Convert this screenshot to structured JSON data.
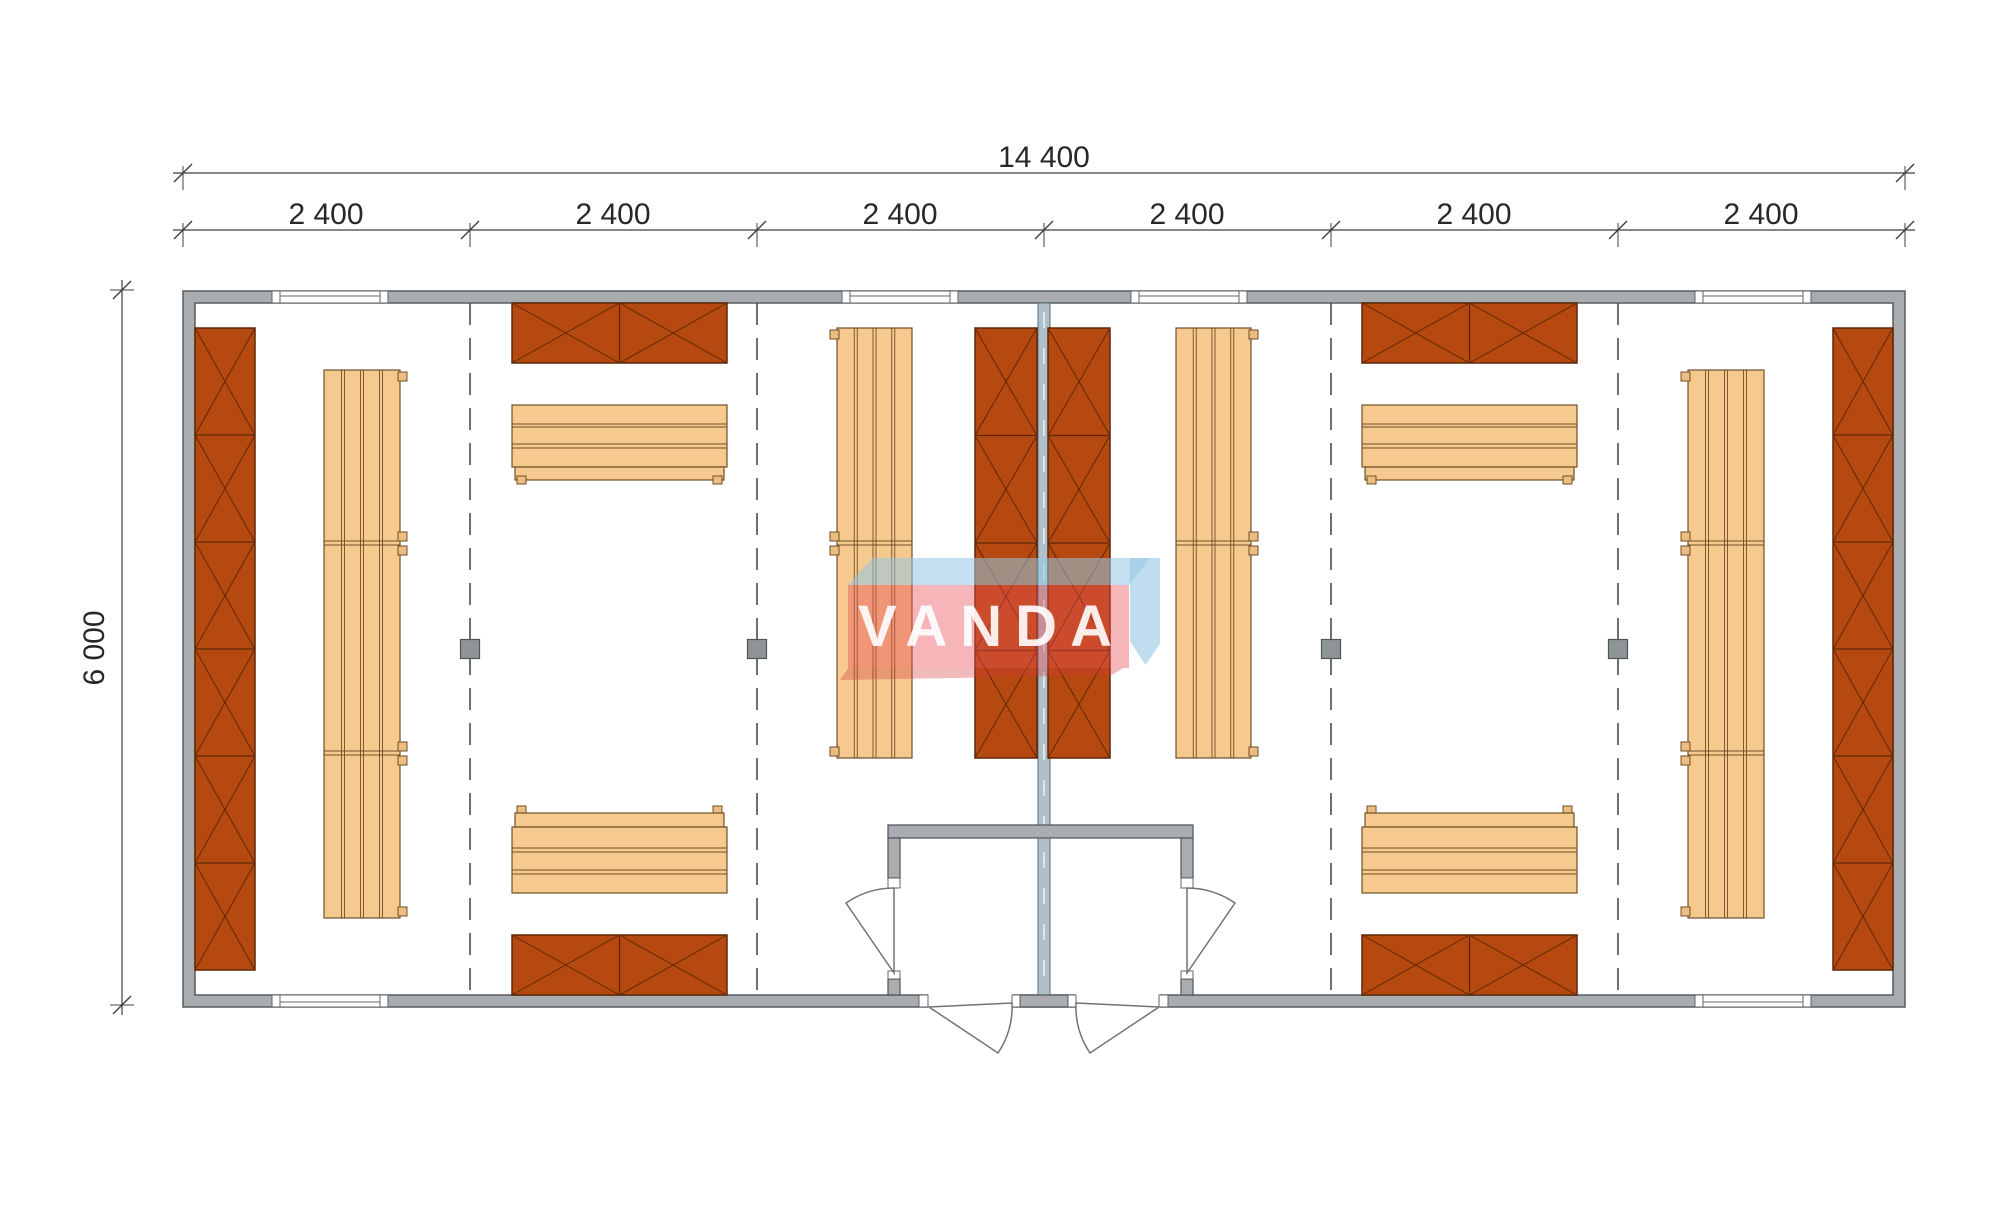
{
  "page": {
    "background": "#ffffff",
    "type": "architectural floor plan"
  },
  "dimensions": {
    "overall_width": "14 400",
    "segments": [
      "2 400",
      "2 400",
      "2 400",
      "2 400",
      "2 400",
      "2 400"
    ],
    "height": "6 000"
  },
  "watermark": {
    "text": "VANDA"
  },
  "colors": {
    "wall_fill": "#a9adb0",
    "wall_stroke": "#595d60",
    "partition_fill": "#afc0ca",
    "partition_stroke": "#5d6e79",
    "partition_dash": "#e8eef2",
    "cabinet_fill": "#b5490f",
    "cabinet_stroke": "#5f2706",
    "bench_fill": "#f6c98f",
    "bench_stroke": "#6f4f26",
    "tab_fill": "#edbc80",
    "grid_line": "#4a4e52",
    "dim_color": "#3c4043",
    "door_stroke": "#6f7377",
    "window_stroke": "#60646a",
    "post_fill": "#8f9497",
    "post_stroke": "#505458"
  },
  "plan": {
    "outer_wall": {
      "x": 183,
      "y": 291,
      "w": 1722,
      "h": 716,
      "thickness": 12
    },
    "cabinets": [
      {
        "x": 195,
        "y": 328,
        "w": 60,
        "h": 642,
        "cells": 6,
        "dir": "v"
      },
      {
        "x": 1833,
        "y": 328,
        "w": 60,
        "h": 642,
        "cells": 6,
        "dir": "v"
      },
      {
        "x": 975,
        "y": 328,
        "w": 62,
        "h": 430,
        "cells": 4,
        "dir": "v"
      },
      {
        "x": 1048,
        "y": 328,
        "w": 62,
        "h": 430,
        "cells": 4,
        "dir": "v"
      },
      {
        "x": 512,
        "y": 303,
        "w": 215,
        "h": 60,
        "cells": 2,
        "dir": "h"
      },
      {
        "x": 512,
        "y": 935,
        "w": 215,
        "h": 60,
        "cells": 2,
        "dir": "h"
      },
      {
        "x": 1362,
        "y": 303,
        "w": 215,
        "h": 60,
        "cells": 2,
        "dir": "h"
      },
      {
        "x": 1362,
        "y": 935,
        "w": 215,
        "h": 60,
        "cells": 2,
        "dir": "h"
      }
    ],
    "benches": [
      {
        "x": 324,
        "y": 370,
        "w": 76,
        "h": 548,
        "planks": 4,
        "divs": [
          543,
          753
        ],
        "tabs": "right"
      },
      {
        "x": 1688,
        "y": 370,
        "w": 76,
        "h": 548,
        "planks": 4,
        "divs": [
          543,
          753
        ],
        "tabs": "left"
      },
      {
        "x": 837,
        "y": 328,
        "w": 75,
        "h": 430,
        "planks": 4,
        "divs": [
          543
        ],
        "tabs": "left"
      },
      {
        "x": 1176,
        "y": 328,
        "w": 75,
        "h": 430,
        "planks": 4,
        "divs": [
          543
        ],
        "tabs": "right"
      }
    ],
    "tables": [
      {
        "x": 512,
        "y": 405,
        "w": 215,
        "variant": "rail-bottom"
      },
      {
        "x": 512,
        "y": 813,
        "w": 215,
        "variant": "rail-top"
      },
      {
        "x": 1362,
        "y": 405,
        "w": 215,
        "variant": "rail-bottom"
      },
      {
        "x": 1362,
        "y": 813,
        "w": 215,
        "variant": "rail-top"
      }
    ],
    "windows": {
      "top": [
        {
          "x": 272,
          "w": 116
        },
        {
          "x": 842,
          "w": 116
        },
        {
          "x": 1131,
          "w": 116
        },
        {
          "x": 1695,
          "w": 116
        }
      ],
      "bottom": [
        {
          "x": 272,
          "w": 116
        },
        {
          "x": 1695,
          "w": 116
        }
      ]
    },
    "grid_lines": [
      470,
      757,
      1331,
      1618
    ],
    "posts": [
      [
        470,
        649
      ],
      [
        757,
        649
      ],
      [
        1331,
        649
      ],
      [
        1618,
        649
      ]
    ],
    "dim_ticks_x": [
      183,
      470,
      757,
      1044,
      1331,
      1618,
      1905
    ],
    "dim_line_overall_y": 173,
    "dim_line_segments_y": 230,
    "dim_line_height_x": 122
  }
}
